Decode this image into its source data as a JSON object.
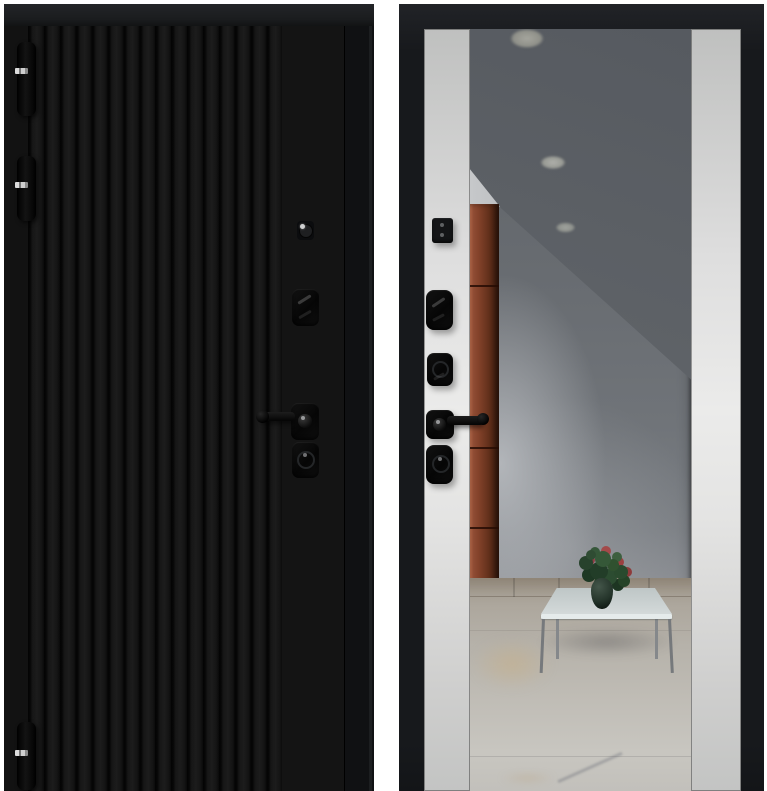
{
  "scene": {
    "kind": "product-photo",
    "subject": "steel-entry-door-two-sides",
    "views": [
      {
        "id": "exterior-side",
        "finish": "black-vertical-slats",
        "parts": [
          "hinge-top",
          "hinge-middle",
          "hinge-bottom",
          "lock-cylinder",
          "upper-escutcheon",
          "door-handle",
          "lower-escutcheon"
        ]
      },
      {
        "id": "interior-side",
        "finish": "light-panels-with-full-length-mirror",
        "parts": [
          "night-latch-cover",
          "deadbolt-upper",
          "deadbolt-middle",
          "interior-handle",
          "deadbolt-lower",
          "mirror"
        ]
      }
    ],
    "mirror_reflection": {
      "elements": [
        "ceiling",
        "recessed-light-1",
        "recessed-light-2",
        "recessed-light-3",
        "brown-cabinet",
        "wall",
        "tiled-floor",
        "glass-coffee-table",
        "potted-plant"
      ]
    }
  },
  "colors": {
    "background": "#ffffff",
    "door_black": "#141414",
    "frame_black": "#17191c",
    "panel_light": "#ebebea",
    "cabinet_brown": "#83422a",
    "floor_beige": "#b6b2aa",
    "table_glass": "#d3d9d9",
    "table_leg": "#76797c",
    "plant_green": "#2f4c33",
    "flower_red": "#a34a4a",
    "metal_silver": "#cfd0d1",
    "hardware_black": "#0a0a0a"
  }
}
